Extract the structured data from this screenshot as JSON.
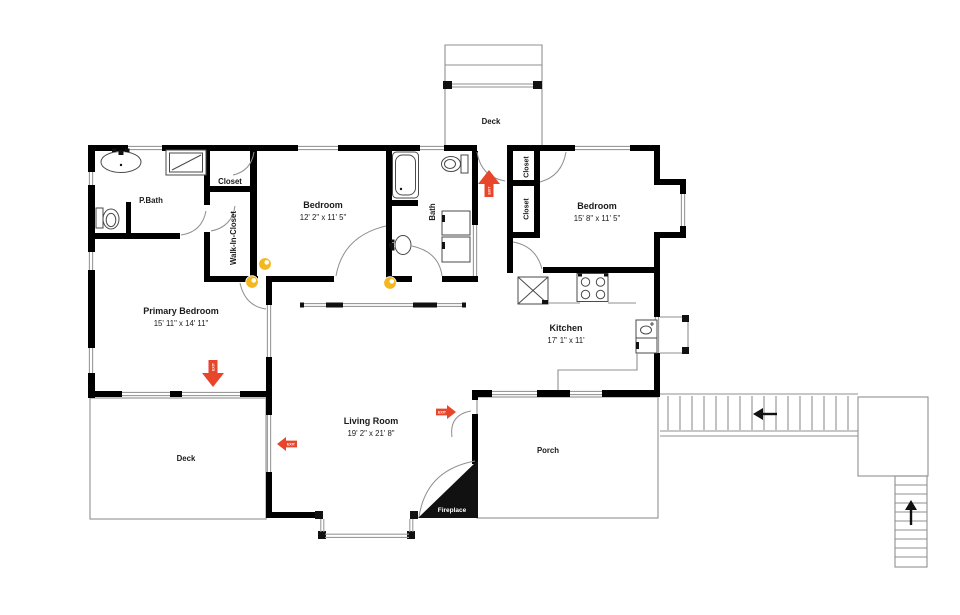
{
  "plan": {
    "rooms": {
      "p_bath": {
        "label": "P.Bath"
      },
      "closet_top_left": {
        "label": "Closet"
      },
      "walk_in_closet": {
        "label": "Walk-In-Closet"
      },
      "bedroom_center": {
        "label": "Bedroom",
        "dims": "12' 2\" x 11' 5\""
      },
      "bath": {
        "label": "Bath"
      },
      "deck_top": {
        "label": "Deck"
      },
      "closet_right_1": {
        "label": "Closet"
      },
      "closet_right_2": {
        "label": "Closet"
      },
      "bedroom_right": {
        "label": "Bedroom",
        "dims": "15' 8\" x 11' 5\""
      },
      "primary_bedroom": {
        "label": "Primary Bedroom",
        "dims": "15' 11\" x 14' 11\""
      },
      "kitchen": {
        "label": "Kitchen",
        "dims": "17' 1\" x 11'"
      },
      "living_room": {
        "label": "Living Room",
        "dims": "19' 2\" x 21' 8\""
      },
      "deck_bottom": {
        "label": "Deck"
      },
      "porch": {
        "label": "Porch"
      },
      "fireplace": {
        "label": "Fireplace"
      }
    },
    "exit_label": "EXIT",
    "colors": {
      "wall": "#000000",
      "outline": "#8f8f8f",
      "exit_arrow": "#e8462b",
      "photo_marker": "#f3b81d"
    }
  }
}
